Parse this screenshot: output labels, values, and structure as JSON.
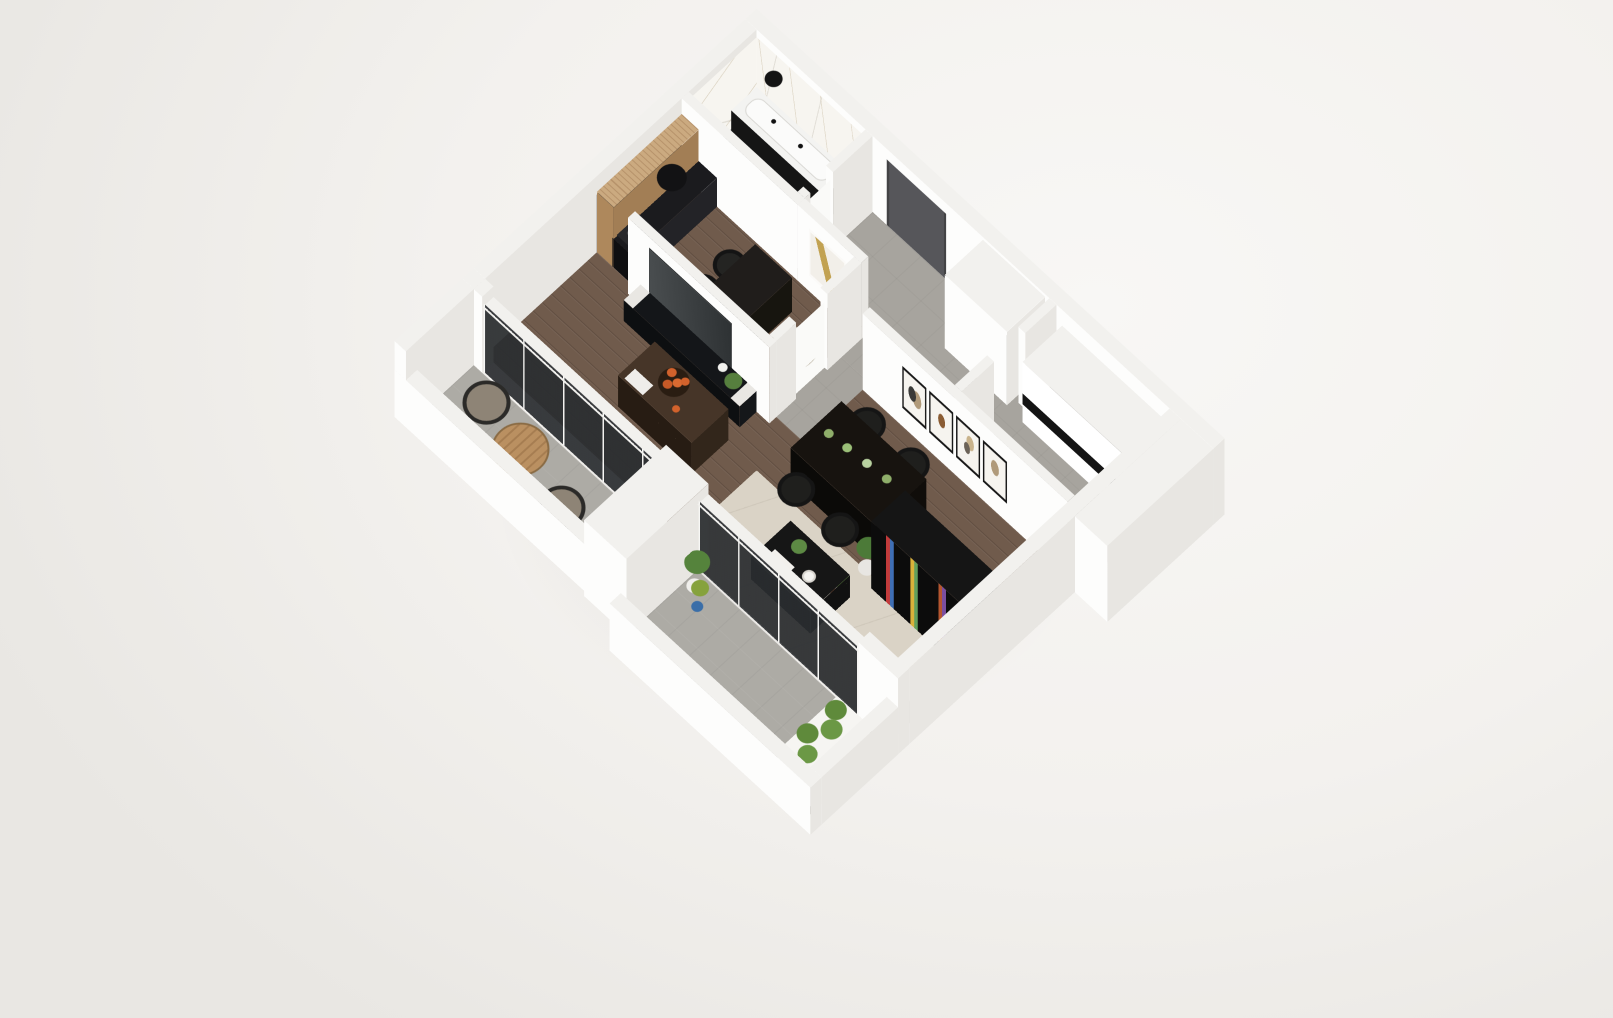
{
  "meta": {
    "kind": "isometric-3d-apartment-floor-plan-render",
    "background": "#f3f1ee"
  },
  "scene": {
    "plan_w": 656,
    "plan_h": 556,
    "wall_h": 58,
    "parapet_h": 36,
    "colors": {
      "wallTop": "#f2f1ee",
      "wallSouth": "#fdfdfc",
      "wallEast": "#e8e6e2"
    },
    "floors": [
      {
        "n": "bathroom-floor",
        "x": 16,
        "y": 16,
        "w": 154,
        "h": 96,
        "cls": "tileA"
      },
      {
        "n": "hallway-floor",
        "x": 180,
        "y": 16,
        "w": 420,
        "h": 134,
        "cls": "tileB"
      },
      {
        "n": "corridor-floor",
        "x": 180,
        "y": 150,
        "w": 130,
        "h": 92,
        "cls": "tileB"
      },
      {
        "n": "kitchen-floor",
        "x": 16,
        "y": 112,
        "w": 244,
        "h": 130,
        "cls": "wood"
      },
      {
        "n": "living-room-floor",
        "x": 16,
        "y": 242,
        "w": 584,
        "h": 158,
        "cls": "wood"
      },
      {
        "n": "dining-area-floor",
        "x": 310,
        "y": 160,
        "w": 290,
        "h": 82,
        "cls": "wood"
      },
      {
        "n": "west-balcony-floor",
        "x": 16,
        "y": 416,
        "w": 256,
        "h": 80,
        "cls": "tileC"
      },
      {
        "n": "south-balcony-floor",
        "x": 332,
        "y": 416,
        "w": 268,
        "h": 108,
        "cls": "tileC"
      }
    ],
    "walls": [
      {
        "n": "exterior-wall-north",
        "x": 0,
        "y": 0,
        "w": 662,
        "h": 16
      },
      {
        "n": "exterior-wall-west",
        "x": 0,
        "y": 16,
        "w": 16,
        "h": 384
      },
      {
        "n": "exterior-wall-east",
        "x": 600,
        "y": 16,
        "w": 16,
        "h": 384
      },
      {
        "n": "exterior-block-east",
        "x": 616,
        "y": 16,
        "w": 46,
        "h": 150
      },
      {
        "n": "south-wall-pier-west",
        "x": 0,
        "y": 400,
        "w": 28,
        "h": 16
      },
      {
        "n": "balcony-separator-block",
        "x": 272,
        "y": 400,
        "w": 60,
        "h": 116
      },
      {
        "n": "south-wall-pier-east",
        "x": 560,
        "y": 400,
        "w": 56,
        "h": 16
      },
      {
        "n": "west-balcony-end-wall",
        "x": 0,
        "y": 400,
        "w": 16,
        "h": 112
      },
      {
        "n": "west-balcony-parapet",
        "x": 0,
        "y": 496,
        "w": 272,
        "h": 16,
        "ht": 36
      },
      {
        "n": "south-balcony-parapet",
        "x": 332,
        "y": 524,
        "w": 284,
        "h": 16,
        "ht": 36
      },
      {
        "n": "south-balcony-parapet-east",
        "x": 600,
        "y": 416,
        "w": 16,
        "h": 108,
        "ht": 36
      },
      {
        "n": "bathroom-wall-east-a",
        "x": 170,
        "y": 16,
        "w": 10,
        "h": 56
      },
      {
        "n": "bathroom-wall-east-b",
        "x": 170,
        "y": 104,
        "w": 10,
        "h": 8
      },
      {
        "n": "bathroom-wall-south",
        "x": 16,
        "y": 112,
        "w": 164,
        "h": 10
      },
      {
        "n": "hall-kitchen-wall",
        "x": 180,
        "y": 112,
        "w": 90,
        "h": 10
      },
      {
        "n": "kitchen-wall-east-a",
        "x": 260,
        "y": 122,
        "w": 10,
        "h": 48
      },
      {
        "n": "kitchen-wall-east-b",
        "x": 260,
        "y": 214,
        "w": 10,
        "h": 28
      },
      {
        "n": "closet-wall-west-a",
        "x": 430,
        "y": 16,
        "w": 10,
        "h": 44
      },
      {
        "n": "closet-wall-west-b",
        "x": 430,
        "y": 104,
        "w": 10,
        "h": 46
      },
      {
        "n": "gallery-wall",
        "x": 310,
        "y": 150,
        "w": 290,
        "h": 10
      },
      {
        "n": "tv-wall",
        "x": 70,
        "y": 242,
        "w": 200,
        "h": 10
      },
      {
        "n": "glass-lintel-west",
        "x": 28,
        "y": 400,
        "w": 244,
        "h": 16,
        "z": 50,
        "flatOnly": true
      },
      {
        "n": "glass-lintel-south",
        "x": 332,
        "y": 400,
        "w": 228,
        "h": 16,
        "z": 50,
        "flatOnly": true
      }
    ],
    "boxes": [
      {
        "n": "bathtub",
        "x": 22,
        "y": 22,
        "w": 132,
        "h": 36,
        "ht": 20,
        "top": "#f3f3f1",
        "south": "#151515",
        "east": "#101012"
      },
      {
        "n": "kitchen-wood-cabinet",
        "x": 16,
        "y": 122,
        "w": 24,
        "h": 120,
        "ht": 46,
        "top": "slats",
        "south": "#ae885c",
        "east": "#a27e55"
      },
      {
        "n": "kitchen-counter",
        "x": 38,
        "y": 122,
        "w": 28,
        "h": 120,
        "ht": 22,
        "top": "#1b1b1e",
        "south": "#0f0f11",
        "east": "#232327"
      },
      {
        "n": "kitchen-table",
        "x": 148,
        "y": 150,
        "w": 52,
        "h": 76,
        "ht": 26,
        "top": "#201d1b",
        "south": "#121110",
        "east": "#17150f"
      },
      {
        "n": "hall-cabinet",
        "x": 336,
        "y": 16,
        "w": 88,
        "h": 54,
        "ht": 56
      },
      {
        "n": "closet-wardrobe",
        "x": 448,
        "y": 16,
        "w": 148,
        "h": 56,
        "ht": 46,
        "south": "linear-gradient(180deg,#ffffff 0 30%,#141414 30% 48%,#ffffff 48%)"
      },
      {
        "n": "tv-console",
        "x": 88,
        "y": 252,
        "w": 164,
        "h": 24,
        "ht": 16,
        "top": "linear-gradient(90deg,#e9e7e3 0 8%,#141619 8% 92%,#e9e7e3 92%)",
        "south": "#0d0f11",
        "east": "#15171a"
      },
      {
        "n": "sideboard",
        "x": 150,
        "y": 294,
        "w": 104,
        "h": 52,
        "ht": 24,
        "top": "#463528",
        "south": "#271c13",
        "east": "#32261b"
      },
      {
        "n": "dining-table",
        "x": 330,
        "y": 210,
        "w": 120,
        "h": 72,
        "ht": 26,
        "top": "#17130f",
        "south": "#0b0a08",
        "east": "#100d0a"
      },
      {
        "n": "bookshelf",
        "x": 470,
        "y": 260,
        "w": 132,
        "h": 48,
        "ht": 52,
        "top": "#151515",
        "east": "#0b0b0b",
        "south": "linear-gradient(90deg,#0c0c0c 0 16%,#c23b3b 16% 20%,#3f6fb5 20% 24%,#0c0c0c 24% 42%,#d9b23a 42% 46%,#62a05c 46% 50%,#0c0c0c 50% 72%,#b5562f 72% 76%,#7a4ea0 76% 80%,#0c0c0c 80%)"
      },
      {
        "n": "coffee-table",
        "x": 378,
        "y": 330,
        "w": 84,
        "h": 56,
        "ht": 18,
        "top": "#161616",
        "south": "#0c0c0c",
        "east": "#111111"
      },
      {
        "n": "balcony-planter",
        "x": 548,
        "y": 434,
        "w": 46,
        "h": 84,
        "ht": 20,
        "top": "#f6f5f2",
        "south": "#ffffff",
        "east": "#eceae6"
      }
    ],
    "flats": [
      {
        "n": "bathtub-basin",
        "x": 30,
        "y": 28,
        "w": 112,
        "h": 22,
        "z": 21,
        "bg": "#fbfbfa",
        "radius": 10,
        "border": "1px solid #d9d8d4"
      },
      {
        "n": "stove",
        "x": 40,
        "y": 206,
        "w": 26,
        "h": 32,
        "z": 23,
        "bg": "#28282a"
      },
      {
        "n": "radiator",
        "x": 76,
        "y": 228,
        "w": 44,
        "h": 13,
        "z": 28,
        "cls": "radiator"
      },
      {
        "n": "area-rug",
        "x": 298,
        "y": 298,
        "w": 286,
        "h": 116,
        "z": 1,
        "cls": "rug",
        "radius": 2
      },
      {
        "n": "sideboard-books",
        "x": 158,
        "y": 330,
        "w": 26,
        "h": 15,
        "z": 25,
        "bg": "#efedea"
      },
      {
        "n": "coffee-table-book",
        "x": 390,
        "y": 364,
        "w": 28,
        "h": 16,
        "z": 19,
        "bg": "#f2f0ec"
      }
    ],
    "vplanes": [
      {
        "n": "bathroom-marble-wall-north",
        "axis": "y",
        "x": 16,
        "y": 16,
        "len": 154,
        "ht": 52,
        "z0": 0,
        "cls": "marble"
      },
      {
        "n": "bathroom-marble-wall-west",
        "axis": "x",
        "x": 16,
        "y": 16,
        "len": 96,
        "ht": 52,
        "z0": 0,
        "cls": "marble"
      },
      {
        "n": "kitchen-backsplash",
        "axis": "x",
        "x": 16,
        "y": 112,
        "len": 130,
        "ht": 44,
        "z0": 0,
        "bg": "#141416"
      },
      {
        "n": "entry-door",
        "axis": "y",
        "x": 200,
        "y": 16,
        "len": 84,
        "ht": 50,
        "z0": 0,
        "bg": "linear-gradient(90deg,#434345 0 4%,#56565a 4% 96%,#434345 96%)"
      },
      {
        "n": "bathroom-door",
        "axis": "x",
        "x": 176,
        "y": 72,
        "len": 32,
        "ht": 50,
        "z0": 0,
        "bg": "#fafaf8"
      },
      {
        "n": "kitchen-door",
        "axis": "x",
        "x": 266,
        "y": 170,
        "len": 44,
        "ht": 50,
        "z0": 0,
        "bg": "#fafaf8"
      },
      {
        "n": "tv-screen",
        "axis": "y",
        "x": 100,
        "y": 252,
        "len": 115,
        "ht": 42,
        "z0": 6,
        "bg": "linear-gradient(100deg,#4a4e50,#2e3234)",
        "border": "1px solid #202324"
      },
      {
        "n": "gold-wall-art",
        "axis": "y",
        "x": 196,
        "y": 122,
        "len": 48,
        "ht": 32,
        "z0": 12,
        "bg": "linear-gradient(120deg,#f2efe9 38%,#c2a252 38% 55%,#f2efe9 55%)",
        "border": "2px solid #fbfaf8"
      },
      {
        "n": "gallery-frame-1",
        "axis": "y",
        "x": 366,
        "y": 160,
        "len": 30,
        "ht": 28,
        "z0": 14,
        "bg": "radial-gradient(circle at 40% 55%, #3a3a38 0 22%, transparent 23%), radial-gradient(circle at 62% 50%, #b09a7a 0 26%, transparent 27%), #f6f4ef",
        "border": "2px solid #161616"
      },
      {
        "n": "gallery-frame-2",
        "axis": "y",
        "x": 404,
        "y": 160,
        "len": 30,
        "ht": 28,
        "z0": 14,
        "bg": "radial-gradient(circle at 52% 55%, #8a5c33 0 22%, transparent 23%), #f6f4ef",
        "border": "2px solid #161616"
      },
      {
        "n": "gallery-frame-3",
        "axis": "y",
        "x": 442,
        "y": 160,
        "len": 30,
        "ht": 28,
        "z0": 14,
        "bg": "radial-gradient(circle at 45% 45%, #6b6257 0 18%, transparent 19%), radial-gradient(circle at 60% 65%, #c9b38c 0 20%, transparent 21%), #f6f4ef",
        "border": "2px solid #161616"
      },
      {
        "n": "gallery-frame-4",
        "axis": "y",
        "x": 480,
        "y": 160,
        "len": 30,
        "ht": 28,
        "z0": 14,
        "bg": "radial-gradient(circle at 50% 60%, #b09a7a 0 24%, transparent 25%), #f6f4ef",
        "border": "2px solid #161616"
      },
      {
        "n": "west-balcony-glass-doors",
        "axis": "y",
        "x": 28,
        "y": 414,
        "len": 244,
        "ht": 52,
        "z0": 0,
        "cls": "glass"
      },
      {
        "n": "south-balcony-glass-doors",
        "axis": "y",
        "x": 332,
        "y": 414,
        "len": 228,
        "ht": 52,
        "z0": 0,
        "cls": "glass"
      }
    ],
    "discs": [
      {
        "n": "shower-head",
        "cx": 58,
        "cy": 34,
        "r": 9,
        "z": 50,
        "bg": "#141414"
      },
      {
        "n": "bathtub-faucet-a",
        "cx": 62,
        "cy": 38,
        "r": 2.5,
        "z": 22,
        "bg": "#111111"
      },
      {
        "n": "bathtub-faucet-b",
        "cx": 100,
        "cy": 38,
        "r": 2.5,
        "z": 22,
        "bg": "#111111"
      },
      {
        "n": "range-hood",
        "cx": 56,
        "cy": 176,
        "r": 15,
        "z": 44,
        "bg": "#121214"
      },
      {
        "n": "stove-burner-1",
        "cx": 48,
        "cy": 214,
        "r": 2.5,
        "z": 24,
        "bg": "#4a4a4c"
      },
      {
        "n": "stove-burner-2",
        "cx": 58,
        "cy": 214,
        "r": 2.5,
        "z": 24,
        "bg": "#4a4a4c"
      },
      {
        "n": "stove-burner-3",
        "cx": 48,
        "cy": 228,
        "r": 2.5,
        "z": 24,
        "bg": "#4a4a4c"
      },
      {
        "n": "stove-burner-4",
        "cx": 58,
        "cy": 228,
        "r": 2.5,
        "z": 24,
        "bg": "#4a4a4c"
      },
      {
        "n": "kitchen-chair-1",
        "cx": 132,
        "cy": 170,
        "r": 13,
        "z": 16,
        "bg": "#242422",
        "ring": "4px solid #141414"
      },
      {
        "n": "kitchen-chair-2",
        "cx": 132,
        "cy": 208,
        "r": 13,
        "z": 16,
        "bg": "#242422",
        "ring": "4px solid #141414"
      },
      {
        "n": "hall-pouf",
        "cx": 242,
        "cy": 188,
        "r": 21,
        "z": 14,
        "bg": "#e2ddd3",
        "ring": "2px solid #cfc9bd"
      },
      {
        "n": "console-plant",
        "cx": 230,
        "cy": 263,
        "r": 9,
        "z": 18,
        "bg": "#567f3e"
      },
      {
        "n": "console-orchid",
        "cx": 212,
        "cy": 260,
        "r": 5,
        "z": 18,
        "bg": "#f2f2ef"
      },
      {
        "n": "fruit-bowl",
        "cx": 196,
        "cy": 313,
        "r": 16,
        "z": 25,
        "bg": "#2a1d12"
      },
      {
        "n": "orange-1",
        "cx": 188,
        "cy": 308,
        "r": 5,
        "z": 26,
        "bg": "#d2622c"
      },
      {
        "n": "orange-2",
        "cx": 200,
        "cy": 312,
        "r": 5,
        "z": 26,
        "bg": "#d96a31"
      },
      {
        "n": "orange-3",
        "cx": 194,
        "cy": 320,
        "r": 5,
        "z": 26,
        "bg": "#c85a27"
      },
      {
        "n": "orange-4",
        "cx": 204,
        "cy": 305,
        "r": 4.5,
        "z": 26,
        "bg": "#d2622c"
      },
      {
        "n": "orange-5",
        "cx": 218,
        "cy": 332,
        "r": 4,
        "z": 25,
        "bg": "#d2622c"
      },
      {
        "n": "dining-chair-1",
        "cx": 352,
        "cy": 196,
        "r": 15,
        "z": 16,
        "bg": "#1f1f1d",
        "ring": "4px solid #151515"
      },
      {
        "n": "dining-chair-2",
        "cx": 414,
        "cy": 196,
        "r": 15,
        "z": 16,
        "bg": "#1f1f1d",
        "ring": "4px solid #151515"
      },
      {
        "n": "dining-chair-3",
        "cx": 352,
        "cy": 296,
        "r": 15,
        "z": 16,
        "bg": "#1f1f1d",
        "ring": "4px solid #151515"
      },
      {
        "n": "dining-chair-4",
        "cx": 414,
        "cy": 296,
        "r": 15,
        "z": 16,
        "bg": "#1f1f1d",
        "ring": "4px solid #151515"
      },
      {
        "n": "green-cup-1",
        "cx": 348,
        "cy": 246,
        "r": 5,
        "z": 28,
        "bg": "#8fae6a"
      },
      {
        "n": "green-cup-2",
        "cx": 372,
        "cy": 244,
        "r": 5,
        "z": 28,
        "bg": "#9bbf78"
      },
      {
        "n": "green-cup-3",
        "cx": 398,
        "cy": 242,
        "r": 5,
        "z": 28,
        "bg": "#b9d2a0"
      },
      {
        "n": "green-cup-4",
        "cx": 424,
        "cy": 240,
        "r": 5,
        "z": 28,
        "bg": "#8fae6a"
      },
      {
        "n": "shelf-plant-pot",
        "cx": 452,
        "cy": 296,
        "r": 9,
        "z": 2,
        "bg": "#e8e6e2"
      },
      {
        "n": "snake-plant",
        "cx": 452,
        "cy": 294,
        "r": 12,
        "z": 16,
        "bg": "#4c7a38"
      },
      {
        "n": "terracotta-pot",
        "cx": 452,
        "cy": 338,
        "r": 7,
        "z": 2,
        "bg": "#9c5a3c"
      },
      {
        "n": "terracotta-plant",
        "cx": 452,
        "cy": 336,
        "r": 10,
        "z": 14,
        "bg": "#6f9c4a"
      },
      {
        "n": "coffee-table-plant",
        "cx": 406,
        "cy": 346,
        "r": 8,
        "z": 20,
        "bg": "#5d8a44"
      },
      {
        "n": "coffee-cup",
        "cx": 434,
        "cy": 360,
        "r": 5,
        "z": 20,
        "bg": "#f4f3f0",
        "ring": "2px solid #d8d5cf"
      },
      {
        "n": "outdoor-chair-1",
        "cx": 64,
        "cy": 446,
        "r": 20,
        "z": 14,
        "bg": "#8e8476",
        "ring": "4px solid #2b2a28"
      },
      {
        "n": "outdoor-chair-2",
        "cx": 198,
        "cy": 474,
        "r": 20,
        "z": 14,
        "bg": "#8e8476",
        "ring": "4px solid #2b2a28"
      },
      {
        "n": "round-wood-table",
        "cx": 128,
        "cy": 462,
        "r": 27,
        "z": 16,
        "cls": "teak",
        "ring": "2px solid #8a6b44"
      },
      {
        "n": "planter-shrub-1",
        "cx": 562,
        "cy": 450,
        "r": 11,
        "z": 24,
        "bg": "#5f8a3b"
      },
      {
        "n": "planter-shrub-2",
        "cx": 574,
        "cy": 468,
        "r": 11,
        "z": 24,
        "bg": "#6b9845"
      },
      {
        "n": "planter-shrub-3",
        "cx": 560,
        "cy": 488,
        "r": 11,
        "z": 24,
        "bg": "#5f8a3b"
      },
      {
        "n": "planter-shrub-4",
        "cx": 576,
        "cy": 504,
        "r": 10,
        "z": 24,
        "bg": "#6b9845"
      },
      {
        "n": "balcony-plant-pot",
        "cx": 344,
        "cy": 432,
        "r": 8,
        "z": 2,
        "bg": "#f0efec"
      },
      {
        "n": "balcony-plant",
        "cx": 344,
        "cy": 428,
        "r": 13,
        "z": 18,
        "bg": "#55833c"
      },
      {
        "n": "balcony-blue-pot",
        "cx": 362,
        "cy": 446,
        "r": 6,
        "z": 2,
        "bg": "#3a6ea8"
      },
      {
        "n": "balcony-blue-pot-plant",
        "cx": 362,
        "cy": 442,
        "r": 9,
        "z": 14,
        "bg": "#86a23c"
      }
    ]
  }
}
